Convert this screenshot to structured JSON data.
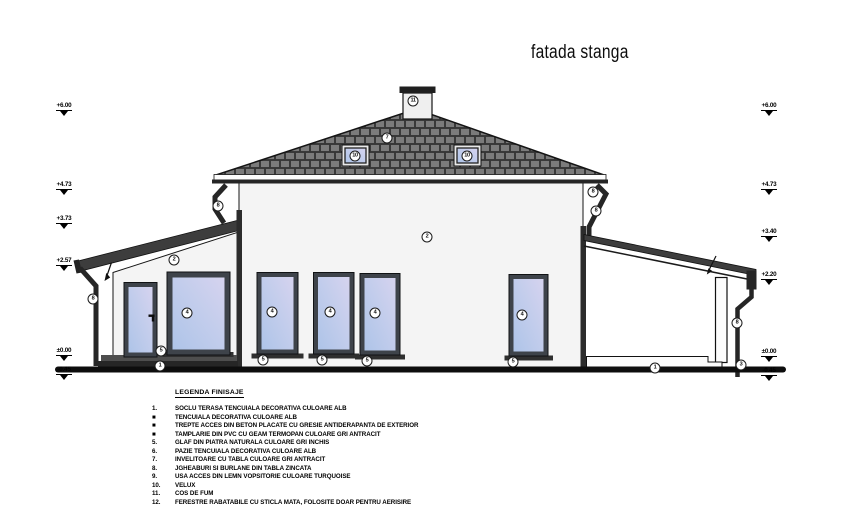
{
  "title": "fatada stanga",
  "legend": {
    "title": "LEGENDA FINISAJE",
    "items": [
      {
        "num": "1.",
        "text": "SOCLU TERASA TENCUIALA DECORATIVA CULOARE ALB"
      },
      {
        "num": "■",
        "text": "TENCUIALA DECORATIVA CULOARE ALB"
      },
      {
        "num": "■",
        "text": "TREPTE ACCES DIN BETON PLACATE CU GRESIE ANTIDERAPANTA DE EXTERIOR"
      },
      {
        "num": "■",
        "text": "TAMPLARIE DIN PVC CU GEAM TERMOPAN CULOARE GRI ANTRACIT"
      },
      {
        "num": "5.",
        "text": "GLAF DIN PIATRA NATURALA CULOARE GRI INCHIS"
      },
      {
        "num": "6.",
        "text": "PAZIE TENCUIALA DECORATIVA CULOARE ALB"
      },
      {
        "num": "7.",
        "text": "INVELITOARE CU TABLA CULOARE GRI ANTRACIT"
      },
      {
        "num": "8.",
        "text": "JGHEABURI SI BURLANE DIN TABLA ZINCATA"
      },
      {
        "num": "9.",
        "text": "USA ACCES DIN LEMN VOPSITORIE CULOARE TURQUOISE"
      },
      {
        "num": "10.",
        "text": "VELUX"
      },
      {
        "num": "11.",
        "text": "COS DE FUM"
      },
      {
        "num": "12.",
        "text": "FERESTRE RABATABILE CU STICLA MATA, FOLOSITE DOAR PENTRU AERISIRE"
      }
    ]
  },
  "markers": {
    "left": [
      {
        "label": "+6.00",
        "x": 51,
        "y": 95
      },
      {
        "label": "+4.73",
        "x": 51,
        "y": 174
      },
      {
        "label": "+3.73",
        "x": 51,
        "y": 208
      },
      {
        "label": "+2.57",
        "x": 51,
        "y": 250
      },
      {
        "label": "±0.00",
        "x": 51,
        "y": 340
      },
      {
        "label": "-0.45",
        "x": 51,
        "y": 359
      }
    ],
    "right": [
      {
        "label": "+6.00",
        "x": 756,
        "y": 95
      },
      {
        "label": "+4.73",
        "x": 756,
        "y": 174
      },
      {
        "label": "+3.40",
        "x": 756,
        "y": 221
      },
      {
        "label": "+2.20",
        "x": 756,
        "y": 264
      },
      {
        "label": "±0.00",
        "x": 756,
        "y": 341
      },
      {
        "label": "-0.45",
        "x": 756,
        "y": 360
      }
    ]
  },
  "callouts": [
    {
      "n": "2",
      "x": 427,
      "y": 237
    },
    {
      "n": "2",
      "x": 174,
      "y": 260
    },
    {
      "n": "4",
      "x": 187,
      "y": 313
    },
    {
      "n": "4",
      "x": 272,
      "y": 312
    },
    {
      "n": "4",
      "x": 330,
      "y": 312
    },
    {
      "n": "4",
      "x": 375,
      "y": 313
    },
    {
      "n": "4",
      "x": 522,
      "y": 315
    },
    {
      "n": "5",
      "x": 161,
      "y": 351
    },
    {
      "n": "5",
      "x": 263,
      "y": 360
    },
    {
      "n": "5",
      "x": 322,
      "y": 360
    },
    {
      "n": "5",
      "x": 367,
      "y": 361
    },
    {
      "n": "5",
      "x": 513,
      "y": 362
    },
    {
      "n": "1",
      "x": 160,
      "y": 366
    },
    {
      "n": "1",
      "x": 655,
      "y": 368
    },
    {
      "n": "3",
      "x": 741,
      "y": 365
    },
    {
      "n": "7",
      "x": 387,
      "y": 138
    },
    {
      "n": "8",
      "x": 93,
      "y": 299
    },
    {
      "n": "8",
      "x": 218,
      "y": 206
    },
    {
      "n": "8",
      "x": 593,
      "y": 192
    },
    {
      "n": "8",
      "x": 596,
      "y": 211
    },
    {
      "n": "8",
      "x": 737,
      "y": 323
    },
    {
      "n": "10",
      "x": 355,
      "y": 156
    },
    {
      "n": "10",
      "x": 467,
      "y": 156
    },
    {
      "n": "11",
      "x": 413,
      "y": 101
    }
  ],
  "colors": {
    "roof_base": "#565656",
    "roof_shingle": "#7b7b7b",
    "wall": "#f4f4f4",
    "frame_anthracite": "#3e434a",
    "glass_blue": "#aec4e8",
    "glass_lavender": "#d6d3ef",
    "gutter_dark": "#262626",
    "ink": "#111111"
  }
}
